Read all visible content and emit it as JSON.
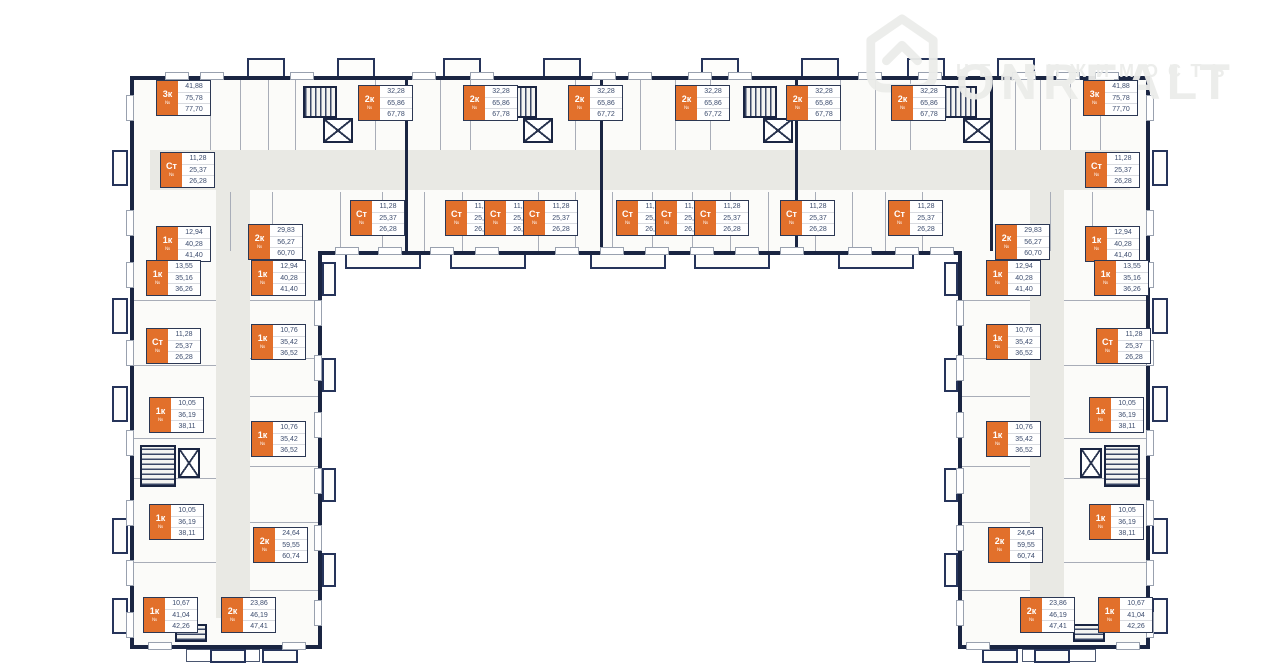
{
  "watermark": {
    "brand": "ONREALT",
    "tagline": "НЕДВИЖИМОСТЬ"
  },
  "unit_prefix": "№",
  "colors": {
    "wall": "#1a2542",
    "label_orange": "#e2702b",
    "corridor": "#e9e9e4",
    "watermark": "#ecedea"
  },
  "labels": [
    {
      "type": "3к",
      "areas": [
        "41,88",
        "75,78",
        "77,70"
      ],
      "x": 156,
      "y": 80
    },
    {
      "type": "2к",
      "areas": [
        "32,28",
        "65,86",
        "67,78"
      ],
      "x": 358,
      "y": 85
    },
    {
      "type": "2к",
      "areas": [
        "32,28",
        "65,86",
        "67,78"
      ],
      "x": 463,
      "y": 85
    },
    {
      "type": "2к",
      "areas": [
        "32,28",
        "65,86",
        "67,72"
      ],
      "x": 568,
      "y": 85
    },
    {
      "type": "2к",
      "areas": [
        "32,28",
        "65,86",
        "67,72"
      ],
      "x": 675,
      "y": 85
    },
    {
      "type": "2к",
      "areas": [
        "32,28",
        "65,86",
        "67,78"
      ],
      "x": 786,
      "y": 85
    },
    {
      "type": "2к",
      "areas": [
        "32,28",
        "65,86",
        "67,78"
      ],
      "x": 891,
      "y": 85
    },
    {
      "type": "3к",
      "areas": [
        "41,88",
        "75,78",
        "77,70"
      ],
      "x": 1083,
      "y": 80
    },
    {
      "type": "Ст",
      "areas": [
        "11,28",
        "25,37",
        "26,28"
      ],
      "x": 160,
      "y": 152
    },
    {
      "type": "Ст",
      "areas": [
        "11,28",
        "25,37",
        "26,28"
      ],
      "x": 1085,
      "y": 152
    },
    {
      "type": "Ст",
      "areas": [
        "11,28",
        "25,37",
        "26,28"
      ],
      "x": 350,
      "y": 200
    },
    {
      "type": "Ст",
      "areas": [
        "11,28",
        "25,37",
        "26,28"
      ],
      "x": 445,
      "y": 200
    },
    {
      "type": "Ст",
      "areas": [
        "11,28",
        "25,37",
        "26,28"
      ],
      "x": 484,
      "y": 200
    },
    {
      "type": "Ст",
      "areas": [
        "11,28",
        "25,37",
        "26,28"
      ],
      "x": 523,
      "y": 200
    },
    {
      "type": "Ст",
      "areas": [
        "11,28",
        "25,37",
        "26,28"
      ],
      "x": 616,
      "y": 200
    },
    {
      "type": "Ст",
      "areas": [
        "11,28",
        "25,37",
        "26,28"
      ],
      "x": 655,
      "y": 200
    },
    {
      "type": "Ст",
      "areas": [
        "11,28",
        "25,37",
        "26,28"
      ],
      "x": 694,
      "y": 200
    },
    {
      "type": "Ст",
      "areas": [
        "11,28",
        "25,37",
        "26,28"
      ],
      "x": 780,
      "y": 200
    },
    {
      "type": "Ст",
      "areas": [
        "11,28",
        "25,37",
        "26,28"
      ],
      "x": 888,
      "y": 200
    },
    {
      "type": "1к",
      "areas": [
        "12,94",
        "40,28",
        "41,40"
      ],
      "x": 156,
      "y": 226
    },
    {
      "type": "2к",
      "areas": [
        "29,83",
        "56,27",
        "60,70"
      ],
      "x": 248,
      "y": 224
    },
    {
      "type": "2к",
      "areas": [
        "29,83",
        "56,27",
        "60,70"
      ],
      "x": 995,
      "y": 224
    },
    {
      "type": "1к",
      "areas": [
        "12,94",
        "40,28",
        "41,40"
      ],
      "x": 1085,
      "y": 226
    },
    {
      "type": "1к",
      "areas": [
        "13,55",
        "35,16",
        "36,26"
      ],
      "x": 146,
      "y": 260
    },
    {
      "type": "1к",
      "areas": [
        "12,94",
        "40,28",
        "41,40"
      ],
      "x": 251,
      "y": 260
    },
    {
      "type": "Ст",
      "areas": [
        "11,28",
        "25,37",
        "26,28"
      ],
      "x": 146,
      "y": 328
    },
    {
      "type": "1к",
      "areas": [
        "10,76",
        "35,42",
        "36,52"
      ],
      "x": 251,
      "y": 324
    },
    {
      "type": "1к",
      "areas": [
        "10,05",
        "36,19",
        "38,11"
      ],
      "x": 149,
      "y": 397
    },
    {
      "type": "1к",
      "areas": [
        "10,76",
        "35,42",
        "36,52"
      ],
      "x": 251,
      "y": 421
    },
    {
      "type": "1к",
      "areas": [
        "10,05",
        "36,19",
        "38,11"
      ],
      "x": 149,
      "y": 504
    },
    {
      "type": "2к",
      "areas": [
        "24,64",
        "59,55",
        "60,74"
      ],
      "x": 253,
      "y": 527
    },
    {
      "type": "1к",
      "areas": [
        "10,67",
        "41,04",
        "42,26"
      ],
      "x": 143,
      "y": 597
    },
    {
      "type": "2к",
      "areas": [
        "23,86",
        "46,19",
        "47,41"
      ],
      "x": 221,
      "y": 597
    },
    {
      "type": "1к",
      "areas": [
        "12,94",
        "40,28",
        "41,40"
      ],
      "x": 986,
      "y": 260
    },
    {
      "type": "1к",
      "areas": [
        "13,55",
        "35,16",
        "36,26"
      ],
      "x": 1094,
      "y": 260
    },
    {
      "type": "1к",
      "areas": [
        "10,76",
        "35,42",
        "36,52"
      ],
      "x": 986,
      "y": 324
    },
    {
      "type": "Ст",
      "areas": [
        "11,28",
        "25,37",
        "26,28"
      ],
      "x": 1096,
      "y": 328
    },
    {
      "type": "1к",
      "areas": [
        "10,05",
        "36,19",
        "38,11"
      ],
      "x": 1089,
      "y": 397
    },
    {
      "type": "1к",
      "areas": [
        "10,76",
        "35,42",
        "36,52"
      ],
      "x": 986,
      "y": 421
    },
    {
      "type": "1к",
      "areas": [
        "10,05",
        "36,19",
        "38,11"
      ],
      "x": 1089,
      "y": 504
    },
    {
      "type": "2к",
      "areas": [
        "24,64",
        "59,55",
        "60,74"
      ],
      "x": 988,
      "y": 527
    },
    {
      "type": "2к",
      "areas": [
        "23,86",
        "46,19",
        "47,41"
      ],
      "x": 1020,
      "y": 597
    },
    {
      "type": "1к",
      "areas": [
        "10,67",
        "41,04",
        "42,26"
      ],
      "x": 1098,
      "y": 597
    }
  ]
}
